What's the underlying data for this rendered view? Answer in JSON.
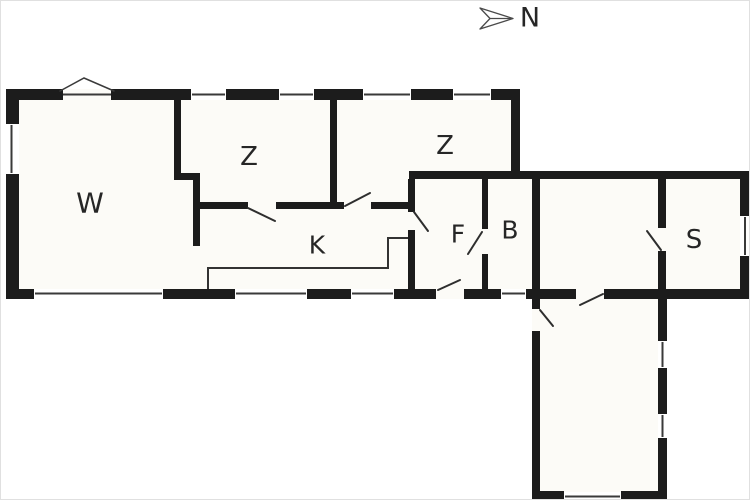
{
  "title": "Holiday home floor plan",
  "compass": {
    "label": "N",
    "icon": "north-arrow-icon"
  },
  "rooms": [
    {
      "id": "living-room",
      "label": "W"
    },
    {
      "id": "bedroom-1",
      "label": "Z"
    },
    {
      "id": "bedroom-2",
      "label": "Z"
    },
    {
      "id": "kitchen",
      "label": "K"
    },
    {
      "id": "hallway",
      "label": "F"
    },
    {
      "id": "bathroom",
      "label": "B"
    },
    {
      "id": "bedroom-3",
      "label": "S"
    }
  ],
  "colors": {
    "wall": "#1c1c1c",
    "floor": "#fcfbf7",
    "background": "#ffffff",
    "thin_line": "#3a3a3a",
    "label_text": "#262626"
  }
}
